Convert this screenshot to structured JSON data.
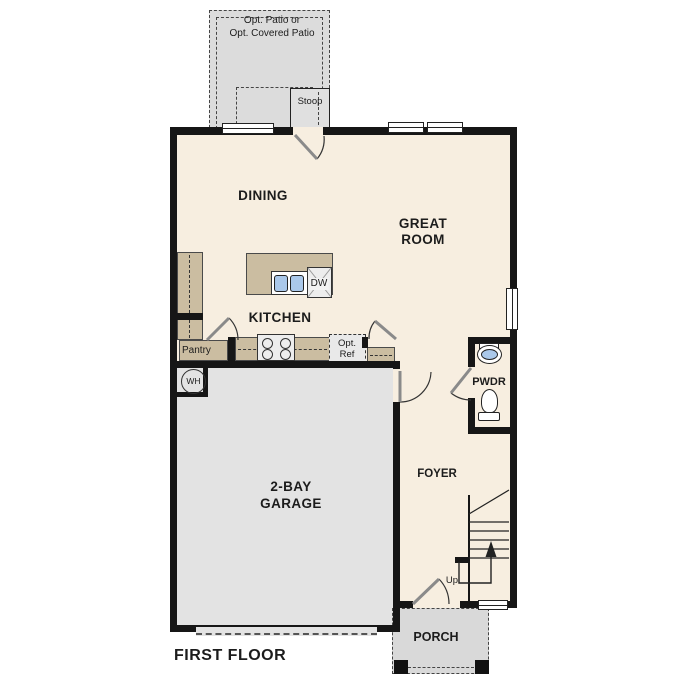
{
  "plan_title": "FIRST FLOOR",
  "rooms": {
    "dining": "DINING",
    "great_room_line1": "GREAT",
    "great_room_line2": "ROOM",
    "kitchen": "KITCHEN",
    "garage_line1": "2-BAY",
    "garage_line2": "GARAGE",
    "foyer": "FOYER",
    "powder": "PWDR",
    "porch": "PORCH",
    "pantry": "Pantry",
    "stoop": "Stoop"
  },
  "options": {
    "patio_line1": "Opt. Patio or",
    "patio_line2": "Opt. Covered Patio",
    "ref_line1": "Opt.",
    "ref_line2": "Ref"
  },
  "appliances": {
    "dishwasher": "DW",
    "water_heater": "WH"
  },
  "stairs": {
    "direction": "Up"
  },
  "colors": {
    "wall": "#161616",
    "interior": "#f7eee0",
    "garage": "#e3e3e3",
    "patio": "#dcdcdc",
    "porch": "#d9d9d9",
    "counter": "#cbbda1",
    "sink_blue": "#aac8ea",
    "appliance": "#ededed"
  }
}
